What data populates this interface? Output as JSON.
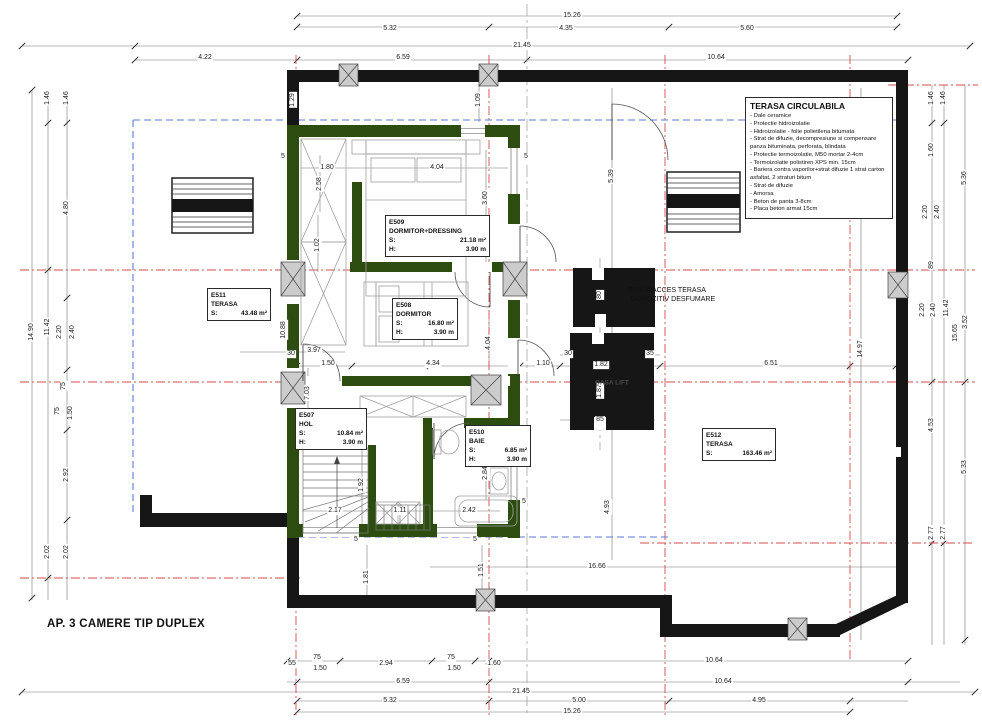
{
  "title": "AP. 3 CAMERE TIP DUPLEX",
  "labels": {
    "s": "S:",
    "h": "H:"
  },
  "colors": {
    "wall_black": "#161616",
    "wall_green": "#2d4d10",
    "axis_red": "#d84b4b",
    "boundary_blue": "#5b79d6"
  },
  "note_box": {
    "title": "TERASA CIRCULABILA",
    "lines": [
      "- Dale ceramice",
      "- Protectie hidroizolatie",
      "- Hidroizolatie - folie polietilena bitumata",
      "- Strat de difuzie, decompresiune si compensare panza bituminata, perforata, blindata",
      "- Protectie termoizolatie, M50 mortar 2-4cm",
      "- Termoizolatie polistiren XPS min. 15cm",
      "- Bariera contra vaporilor+strat difuzie 1 strat carton asfaltat, 2 straturi bitum",
      "- Strat de difuzie",
      "- Amorsa",
      "- Beton de panta 3-8cm",
      "- Placa beton armat 15cm"
    ]
  },
  "trapa_note": {
    "line1": "TRAPA ACCES TERASA",
    "line2": "-DISPOZITIV DESFUMARE"
  },
  "lift_label": "CASA LIFT",
  "rooms": [
    {
      "id": "E509",
      "name": "DORMITOR+DRESSING",
      "s": "21.18 m²",
      "h": "3.90 m"
    },
    {
      "id": "E508",
      "name": "DORMITOR",
      "s": "16.80 m²",
      "h": "3.90 m"
    },
    {
      "id": "E507",
      "name": "HOL",
      "s": "10.84 m²",
      "h": "3.90 m"
    },
    {
      "id": "E510",
      "name": "BAIE",
      "s": "6.85 m²",
      "h": "3.90 m"
    },
    {
      "id": "E511",
      "name": "TERASA",
      "s": "43.48 m²"
    },
    {
      "id": "E512",
      "name": "TERASA",
      "s": "163.46 m²"
    }
  ],
  "dimensions": [
    {
      "t": "15.26",
      "x": 572,
      "y": 16
    },
    {
      "t": "5.32",
      "x": 390,
      "y": 29
    },
    {
      "t": "4.35",
      "x": 566,
      "y": 29
    },
    {
      "t": "5.60",
      "x": 747,
      "y": 29
    },
    {
      "t": "21.45",
      "x": 522,
      "y": 46
    },
    {
      "t": "4.22",
      "x": 205,
      "y": 58
    },
    {
      "t": "6.59",
      "x": 403,
      "y": 58
    },
    {
      "t": "10.64",
      "x": 716,
      "y": 58
    },
    {
      "t": "55",
      "x": 292,
      "y": 664
    },
    {
      "t": "75",
      "x": 317,
      "y": 658
    },
    {
      "t": "1.50",
      "x": 320,
      "y": 669
    },
    {
      "t": "2.94",
      "x": 386,
      "y": 664
    },
    {
      "t": "75",
      "x": 451,
      "y": 658
    },
    {
      "t": "1.50",
      "x": 454,
      "y": 669
    },
    {
      "t": "1.60",
      "x": 494,
      "y": 664
    },
    {
      "t": "10.64",
      "x": 714,
      "y": 661
    },
    {
      "t": "6.59",
      "x": 403,
      "y": 682
    },
    {
      "t": "10.64",
      "x": 723,
      "y": 682
    },
    {
      "t": "21.45",
      "x": 521,
      "y": 692
    },
    {
      "t": "5.32",
      "x": 390,
      "y": 701
    },
    {
      "t": "5.00",
      "x": 579,
      "y": 701
    },
    {
      "t": "4.95",
      "x": 759,
      "y": 701
    },
    {
      "t": "15.26",
      "x": 572,
      "y": 712
    },
    {
      "t": "1.46",
      "x": 48,
      "y": 98,
      "r": 1
    },
    {
      "t": "1.46",
      "x": 67,
      "y": 98,
      "r": 1
    },
    {
      "t": "4.80",
      "x": 67,
      "y": 208,
      "r": 1
    },
    {
      "t": "14.90",
      "x": 32,
      "y": 332,
      "r": 1
    },
    {
      "t": "11.42",
      "x": 48,
      "y": 327,
      "r": 1
    },
    {
      "t": "2.20",
      "x": 60,
      "y": 332,
      "r": 1
    },
    {
      "t": "2.40",
      "x": 73,
      "y": 332,
      "r": 1
    },
    {
      "t": "75",
      "x": 64,
      "y": 386,
      "r": 1
    },
    {
      "t": "75",
      "x": 58,
      "y": 411,
      "r": 1
    },
    {
      "t": "1.50",
      "x": 71,
      "y": 413,
      "r": 1
    },
    {
      "t": "2.92",
      "x": 67,
      "y": 475,
      "r": 1
    },
    {
      "t": "2.02",
      "x": 48,
      "y": 552,
      "r": 1
    },
    {
      "t": "2.02",
      "x": 67,
      "y": 552,
      "r": 1
    },
    {
      "t": "1.46",
      "x": 932,
      "y": 98,
      "r": 1
    },
    {
      "t": "1.46",
      "x": 944,
      "y": 98,
      "r": 1
    },
    {
      "t": "1.60",
      "x": 932,
      "y": 150,
      "r": 1
    },
    {
      "t": "5.36",
      "x": 965,
      "y": 178,
      "r": 1
    },
    {
      "t": "2.20",
      "x": 926,
      "y": 212,
      "r": 1
    },
    {
      "t": "2.40",
      "x": 938,
      "y": 212,
      "r": 1
    },
    {
      "t": "89",
      "x": 932,
      "y": 265,
      "r": 1
    },
    {
      "t": "2.20",
      "x": 923,
      "y": 310,
      "r": 1
    },
    {
      "t": "2.40",
      "x": 934,
      "y": 310,
      "r": 1
    },
    {
      "t": "11.42",
      "x": 947,
      "y": 308,
      "r": 1
    },
    {
      "t": "15.65",
      "x": 956,
      "y": 333,
      "r": 1
    },
    {
      "t": "3.52",
      "x": 966,
      "y": 322,
      "r": 1
    },
    {
      "t": "4.53",
      "x": 932,
      "y": 425,
      "r": 1
    },
    {
      "t": "5.33",
      "x": 965,
      "y": 467,
      "r": 1
    },
    {
      "t": "2.77",
      "x": 932,
      "y": 533,
      "r": 1
    },
    {
      "t": "2.77",
      "x": 944,
      "y": 533,
      "r": 1
    },
    {
      "t": "1.29",
      "x": 293,
      "y": 100,
      "r": 1
    },
    {
      "t": "1.09",
      "x": 479,
      "y": 100,
      "r": 1
    },
    {
      "t": "5",
      "x": 283,
      "y": 157
    },
    {
      "t": "1.80",
      "x": 327,
      "y": 168
    },
    {
      "t": "4.04",
      "x": 437,
      "y": 168
    },
    {
      "t": "5",
      "x": 526,
      "y": 157
    },
    {
      "t": "2.58",
      "x": 320,
      "y": 184,
      "r": 1
    },
    {
      "t": "3.60",
      "x": 486,
      "y": 198,
      "r": 1
    },
    {
      "t": "1.02",
      "x": 318,
      "y": 245,
      "r": 1
    },
    {
      "t": "10.88",
      "x": 284,
      "y": 330,
      "r": 1
    },
    {
      "t": "30",
      "x": 291,
      "y": 354
    },
    {
      "t": "3.97",
      "x": 314,
      "y": 351
    },
    {
      "t": "1.50",
      "x": 328,
      "y": 364
    },
    {
      "t": "4.34",
      "x": 433,
      "y": 364
    },
    {
      "t": "1.10",
      "x": 543,
      "y": 364
    },
    {
      "t": "30",
      "x": 568,
      "y": 354
    },
    {
      "t": "1.82",
      "x": 601,
      "y": 365
    },
    {
      "t": "35",
      "x": 650,
      "y": 354
    },
    {
      "t": "1.87",
      "x": 600,
      "y": 391,
      "r": 1
    },
    {
      "t": "85",
      "x": 600,
      "y": 420
    },
    {
      "t": "80",
      "x": 600,
      "y": 295,
      "r": 1
    },
    {
      "t": "6.51",
      "x": 771,
      "y": 364
    },
    {
      "t": "14.97",
      "x": 861,
      "y": 349,
      "r": 1
    },
    {
      "t": "5.39",
      "x": 612,
      "y": 176,
      "r": 1
    },
    {
      "t": "7.03",
      "x": 308,
      "y": 393,
      "r": 1
    },
    {
      "t": "4.04",
      "x": 489,
      "y": 343,
      "r": 1
    },
    {
      "t": "92",
      "x": 362,
      "y": 440,
      "r": 1
    },
    {
      "t": "1.92",
      "x": 362,
      "y": 485,
      "r": 1
    },
    {
      "t": "2.17",
      "x": 335,
      "y": 511
    },
    {
      "t": "1.11",
      "x": 400,
      "y": 511
    },
    {
      "t": "2.42",
      "x": 469,
      "y": 511
    },
    {
      "t": "2.84",
      "x": 486,
      "y": 473,
      "r": 1
    },
    {
      "t": "4.93",
      "x": 608,
      "y": 507,
      "r": 1
    },
    {
      "t": "16.66",
      "x": 597,
      "y": 567
    },
    {
      "t": "1.81",
      "x": 367,
      "y": 577,
      "r": 1
    },
    {
      "t": "1.51",
      "x": 482,
      "y": 570,
      "r": 1
    },
    {
      "t": "5",
      "x": 356,
      "y": 540
    },
    {
      "t": "5",
      "x": 475,
      "y": 540
    },
    {
      "t": "5",
      "x": 524,
      "y": 502
    }
  ]
}
